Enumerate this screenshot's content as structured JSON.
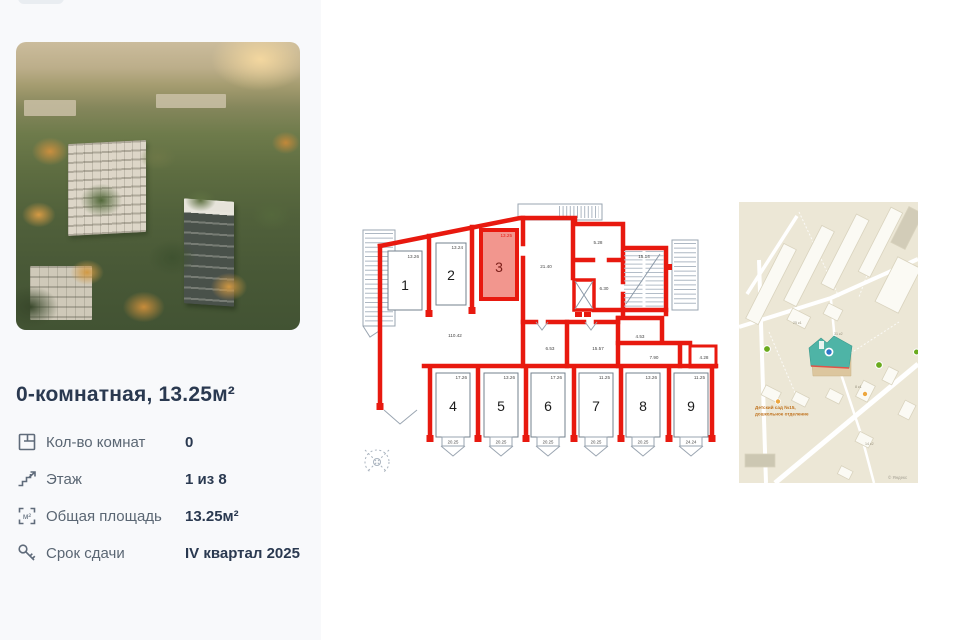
{
  "panel": {
    "title": "0-комнатная, 13.25м²",
    "details": [
      {
        "label": "Кол-во комнат",
        "value": "0"
      },
      {
        "label": "Этаж",
        "value": "1 из 8"
      },
      {
        "label": "Общая площадь",
        "value": "13.25м²"
      },
      {
        "label": "Срок сдачи",
        "value": "IV квартал 2025"
      }
    ]
  },
  "floorplan": {
    "wall_color": "#e8190f",
    "highlight_fill": "#f2968e",
    "units": [
      {
        "number": "1",
        "area": "13.26"
      },
      {
        "number": "2",
        "area": "13.24"
      },
      {
        "number": "3",
        "area": "13.25"
      },
      {
        "number": "4",
        "area": "17.26",
        "balcony": "20.25"
      },
      {
        "number": "5",
        "area": "13.26",
        "balcony": "20.25"
      },
      {
        "number": "6",
        "area": "17.26",
        "balcony": "20.25"
      },
      {
        "number": "7",
        "area": "11.25",
        "balcony": "20.25"
      },
      {
        "number": "8",
        "area": "13.26",
        "balcony": "20.25"
      },
      {
        "number": "9",
        "area": "11.25",
        "balcony": "24.24"
      }
    ],
    "rooms": [
      {
        "name": "corridor",
        "area": "110.42"
      },
      {
        "name": "living",
        "area": "21.40"
      },
      {
        "name": "hall",
        "area": "5.28"
      },
      {
        "name": "stairwell",
        "area": "15.14"
      },
      {
        "name": "elevator-lobby",
        "area": "6.30"
      },
      {
        "name": "room-a",
        "area": "6.53"
      },
      {
        "name": "room-b",
        "area": "15.57"
      },
      {
        "name": "room-c",
        "area": "4.53"
      },
      {
        "name": "room-d",
        "area": "7.90"
      },
      {
        "name": "room-e",
        "area": "4.28"
      }
    ]
  },
  "map": {
    "poi_label_lines": [
      "Детский сад №15,",
      "дошкольное отделение"
    ],
    "building_labels": [
      "31 к2",
      "25 к1",
      "8 к1",
      "14 к2"
    ],
    "attribution": "© Яндекс",
    "highlight_roof_color": "#4eb4a6",
    "marker_color": "#2f76c9"
  }
}
